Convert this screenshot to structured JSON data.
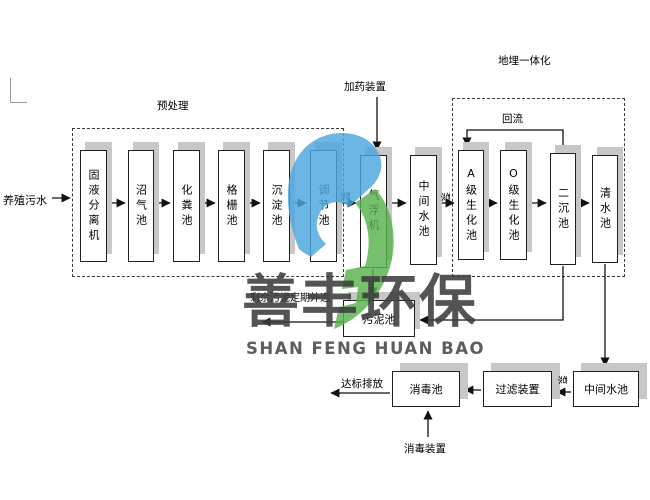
{
  "diagram": {
    "source_label": "养殖污水",
    "sections": {
      "pretreatment": "预处理",
      "buried_integration": "地埋一体化"
    },
    "annotations": {
      "dosing_device": "加药装置",
      "reflux": "回流",
      "discharge": "达标排放",
      "disinfection_device": "消毒装置",
      "sludge_out": "剩余污泥定期外运",
      "pump": "泵"
    },
    "tanks_main": [
      {
        "label": "固液分离机"
      },
      {
        "label": "沼气池"
      },
      {
        "label": "化粪池"
      },
      {
        "label": "格栅池"
      },
      {
        "label": "沉淀池"
      },
      {
        "label": "调节池"
      },
      {
        "label": "气浮机"
      },
      {
        "label": "中间水池"
      },
      {
        "label": "A级生化池"
      },
      {
        "label": "O级生化池"
      },
      {
        "label": "二沉池"
      },
      {
        "label": "清水池"
      }
    ],
    "tanks_bottom": [
      {
        "label": "消毒池"
      },
      {
        "label": "过滤装置"
      },
      {
        "label": "中间水池"
      }
    ],
    "sludge_tank_label": "污泥池"
  },
  "watermark": {
    "name_cn": "善丰环保",
    "name_en": "SHAN FENG HUAN BAO",
    "logo_blue": "#4da7e0",
    "logo_green": "#58b24e"
  }
}
